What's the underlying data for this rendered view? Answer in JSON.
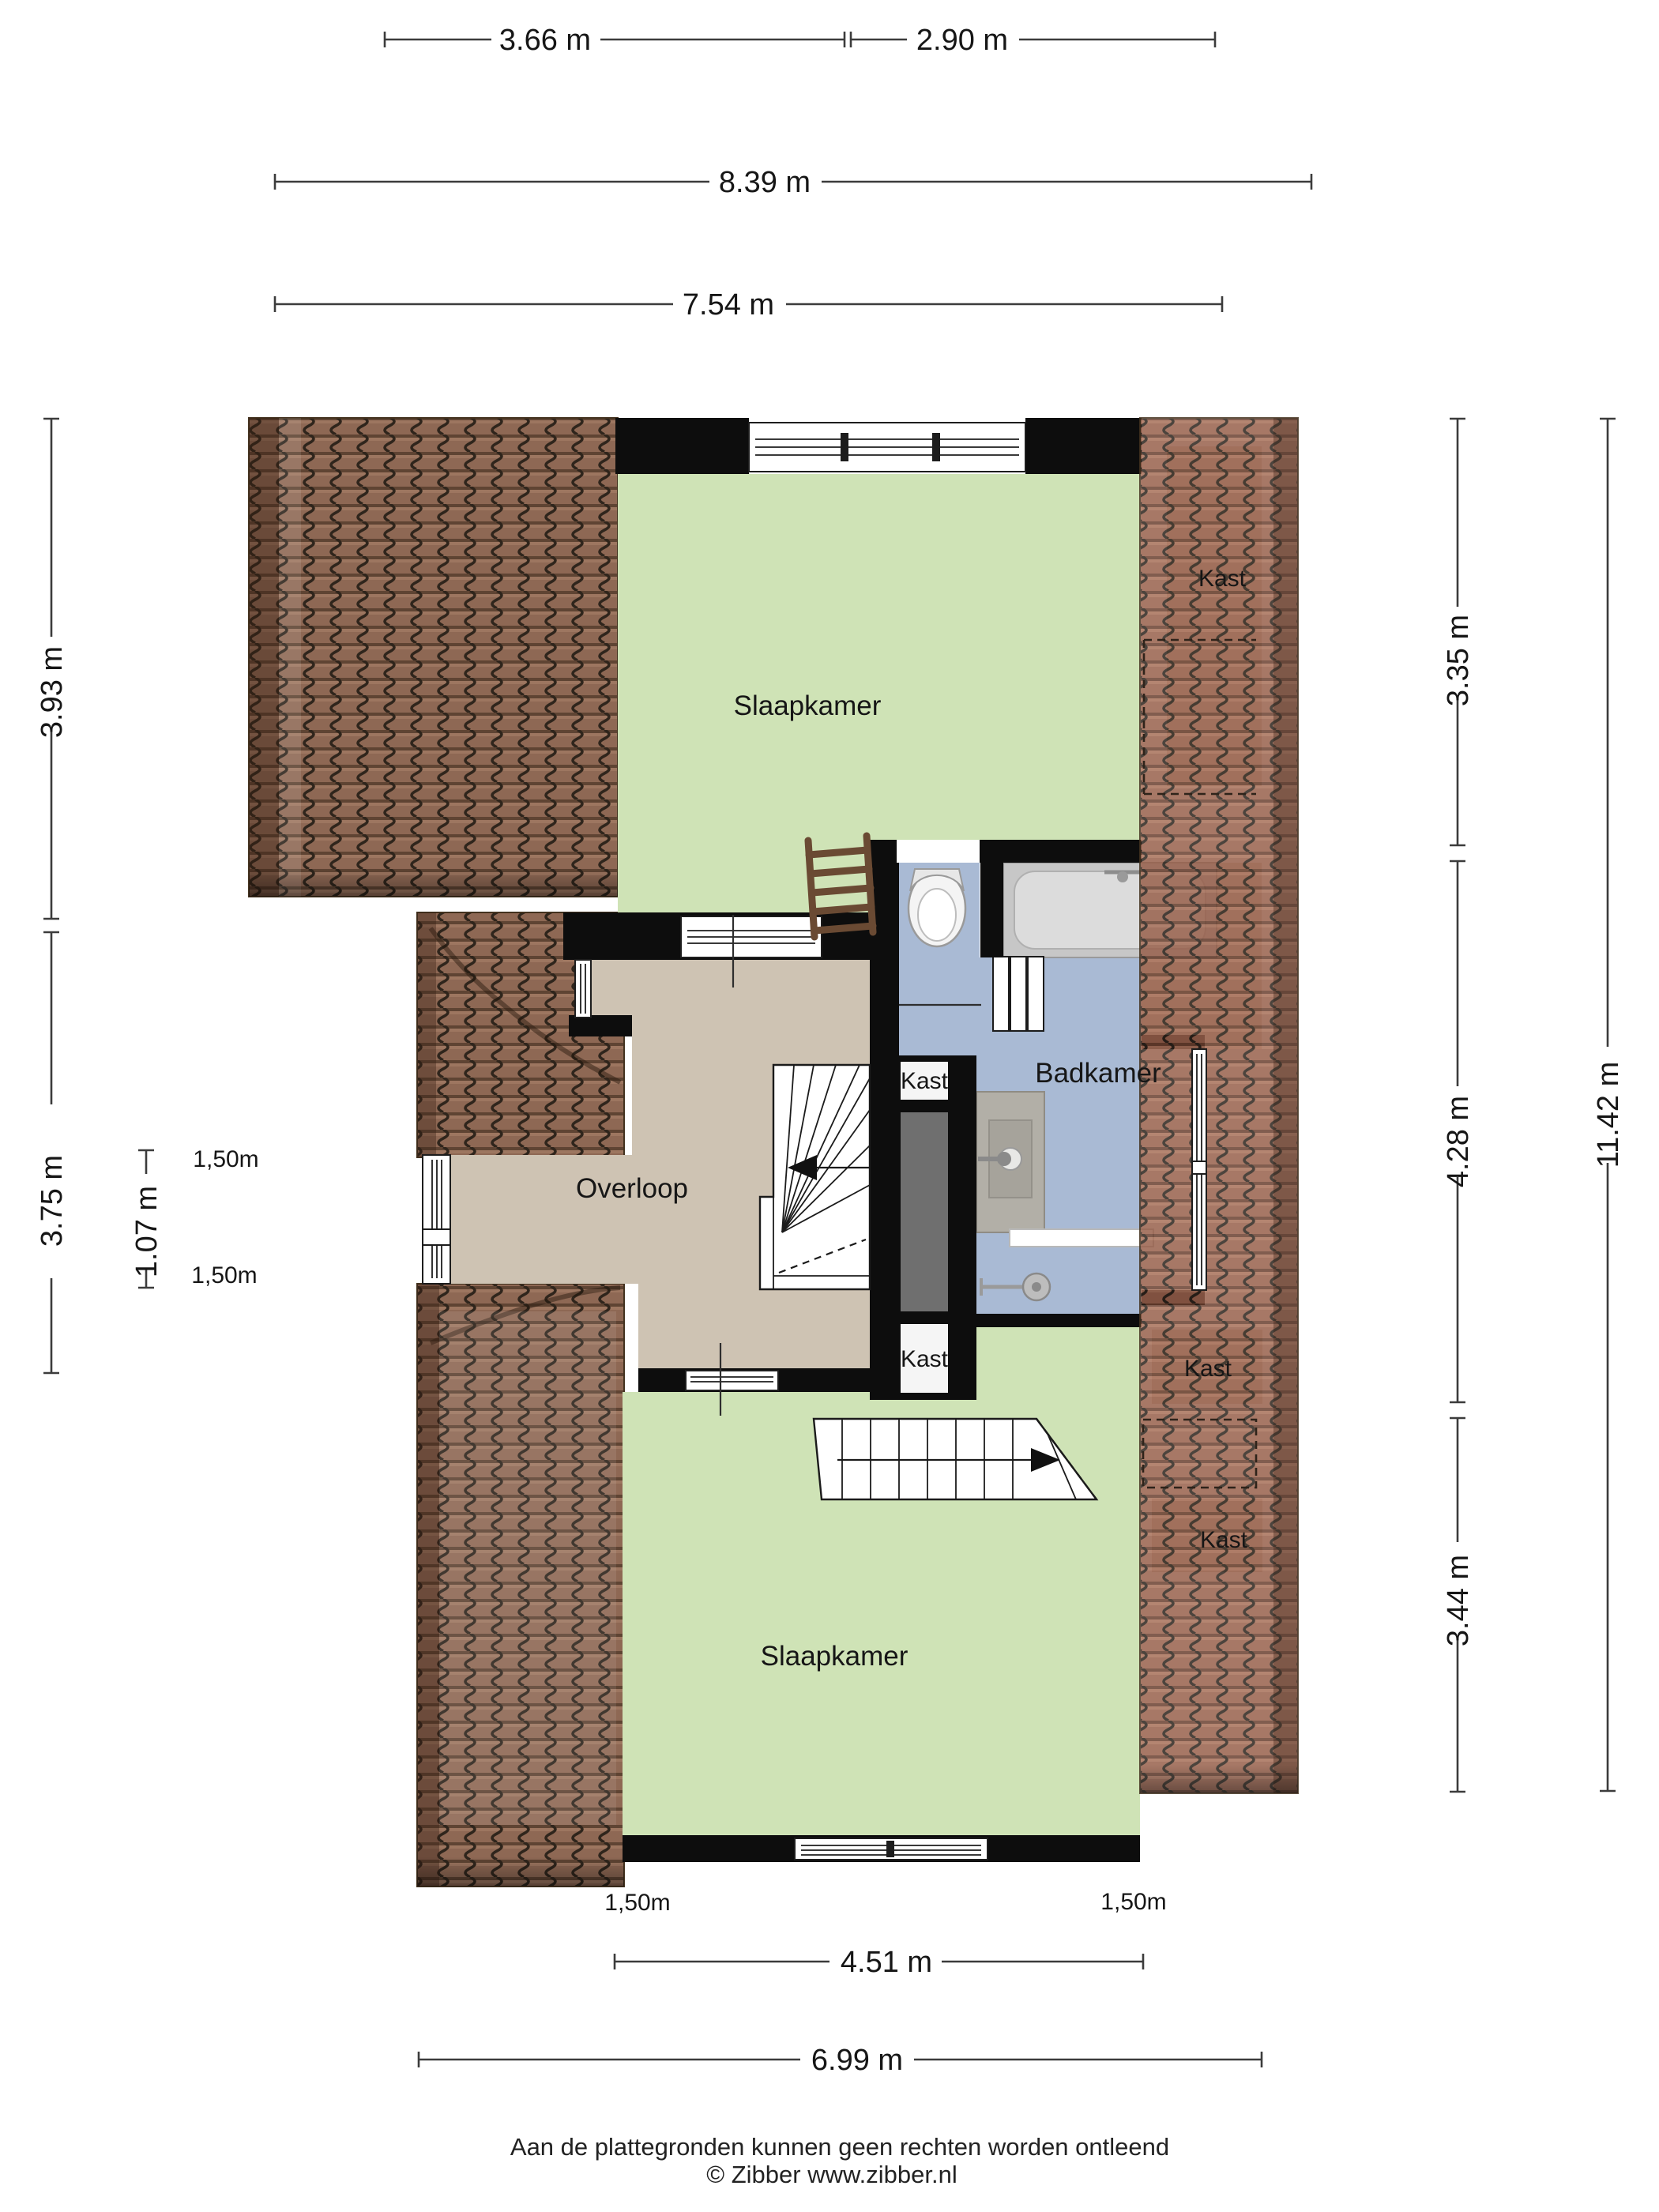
{
  "plan": {
    "rooms": {
      "bedroom_top": "Slaapkamer",
      "bedroom_bottom": "Slaapkamer",
      "landing": "Overloop",
      "bathroom": "Badkamer",
      "closet_roof_top": "Kast",
      "closet_shaft_upper": "Kast",
      "closet_shaft_lower": "Kast",
      "closet_roof_mid": "Kast",
      "closet_roof_bottom": "Kast"
    },
    "dims": {
      "w_top_left": "3.66 m",
      "w_top_right": "2.90 m",
      "w_total": "8.39 m",
      "w_inner": "7.54 m",
      "h_left_top": "3.93 m",
      "h_left_mid": "3.75 m",
      "h_left_small": "1.07 m",
      "h_right_top": "3.35 m",
      "h_right_mid": "4.28 m",
      "h_right_total": "11.42 m",
      "h_right_bottom": "3.44 m",
      "w_bottom_inner": "4.51 m",
      "w_bottom": "6.99 m",
      "k_left_upper": "1,50m",
      "k_left_lower": "1,50m",
      "k_bottom_left": "1,50m",
      "k_bottom_right": "1,50m"
    },
    "colors": {
      "roof_brown": "#8e6854",
      "roof_red": "#975f4a",
      "room_green": "#cfe3b6",
      "landing_tan": "#cec3b3",
      "bathroom_blue": "#a9bad4",
      "under_roof": "#d8cabb",
      "wall_black": "#0d0d0d",
      "shaft_gray": "#6f6f6f"
    }
  },
  "footer": {
    "disclaimer": "Aan de plattegronden kunnen geen rechten worden ontleend",
    "copyright": "© Zibber www.zibber.nl"
  }
}
